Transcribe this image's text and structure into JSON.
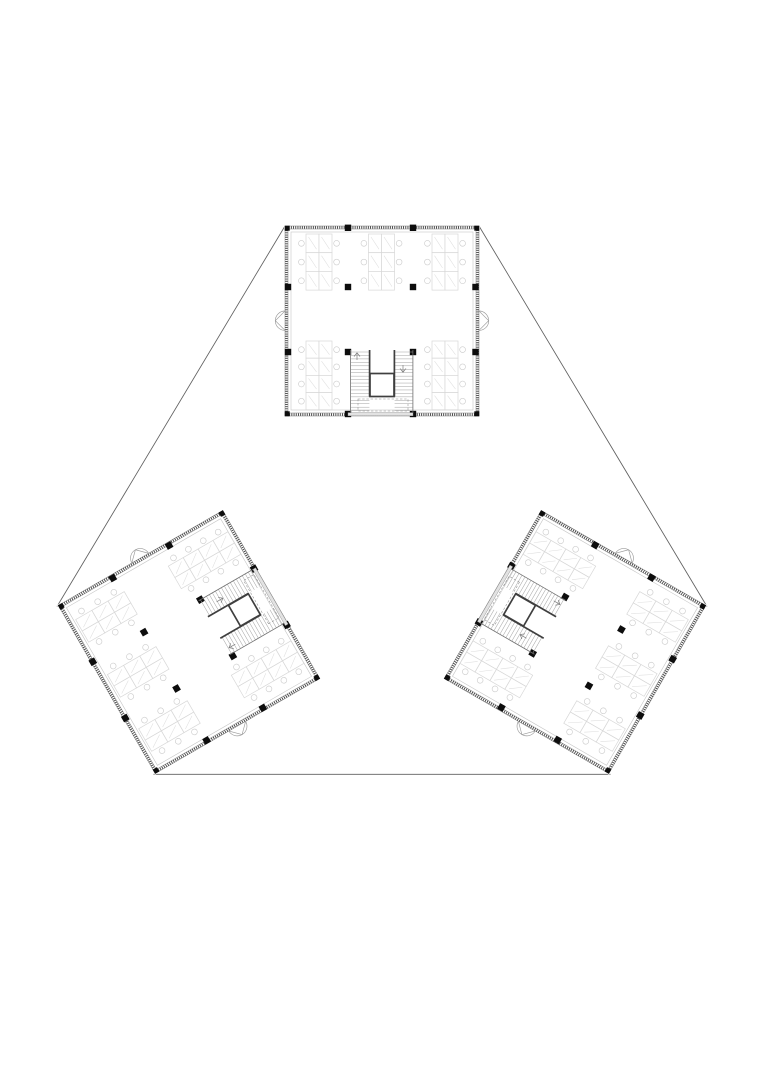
{
  "page": {
    "background": "#ffffff",
    "width": 764,
    "height": 1080,
    "description": "Architectural floor plan drawing: three identical square office floor plates arranged in a triangle, outer corners joined by thin site lines"
  },
  "palette": {
    "wall_hatch": "#3d3d3d",
    "wall_line": "#7a7a7a",
    "finish_line": "#c6c6c6",
    "column": "#0d0d0d",
    "core_wall": "#3f3f3f",
    "stair_tread": "#a2a2a2",
    "landing_dashed": "#8d8d8d",
    "door": "#9b9b9b",
    "desk": "#d7d7d7",
    "chair": "#cecece",
    "site_line": "#5f5f5f",
    "background": "#ffffff"
  },
  "summary": {
    "blocks": 3,
    "desk_clusters_per_block": 5,
    "desks_per_block": 34,
    "columns_per_block": 16,
    "stair_flights_per_core": 2,
    "doors_per_block": 2
  },
  "plan": {
    "blocks": [
      {
        "id": "building-block-top",
        "transform": "translate(382,321)"
      },
      {
        "id": "building-block-left",
        "transform": "translate(189,642) rotate(-120)"
      },
      {
        "id": "building-block-right",
        "transform": "translate(575,642) rotate(120)"
      }
    ],
    "connectors": [
      {
        "id": "site-line-left",
        "d": "M285,226 L57,606.5"
      },
      {
        "id": "site-line-right",
        "d": "M479,226 L707,606.5"
      },
      {
        "id": "site-line-bottom",
        "d": "M153.5,774.3 L610.5,774.3"
      }
    ],
    "block": {
      "size": {
        "w": 194,
        "h": 190
      },
      "column_size": 6.4,
      "corner_column_size": 5,
      "columns": [
        [
          63,
          1.8
        ],
        [
          128,
          1.8
        ],
        [
          3,
          61
        ],
        [
          63,
          61
        ],
        [
          128,
          61
        ],
        [
          190.5,
          61
        ],
        [
          3,
          126
        ],
        [
          63,
          126
        ],
        [
          128,
          126
        ],
        [
          190.5,
          126
        ],
        [
          63,
          188
        ],
        [
          128,
          188
        ]
      ],
      "corner_columns": [
        [
          2.2,
          2.2
        ],
        [
          191.8,
          2.2
        ],
        [
          2.2,
          187.8
        ],
        [
          191.8,
          187.8
        ]
      ],
      "clusters": [
        {
          "type": "cluster3",
          "x": 21,
          "y": 8
        },
        {
          "type": "cluster3",
          "x": 83.5,
          "y": 8
        },
        {
          "type": "cluster3",
          "x": 147,
          "y": 8
        },
        {
          "type": "cluster4",
          "x": 21,
          "y": 115
        },
        {
          "type": "cluster4",
          "x": 147,
          "y": 115
        }
      ],
      "cluster_types": {
        "cluster3": {
          "rows": 3,
          "row_h": 18.7
        },
        "cluster4": {
          "rows": 4,
          "row_h": 17.2
        }
      },
      "desk": {
        "w": 13,
        "chair_r": 2.9,
        "chair_gap": 4.6
      },
      "stair": {
        "tread_count": 18,
        "tread_step": 3.45,
        "top_y": 126,
        "left_flight_x": [
          66,
          84.4
        ],
        "right_flight_x": [
          109.6,
          127.6
        ]
      }
    }
  }
}
